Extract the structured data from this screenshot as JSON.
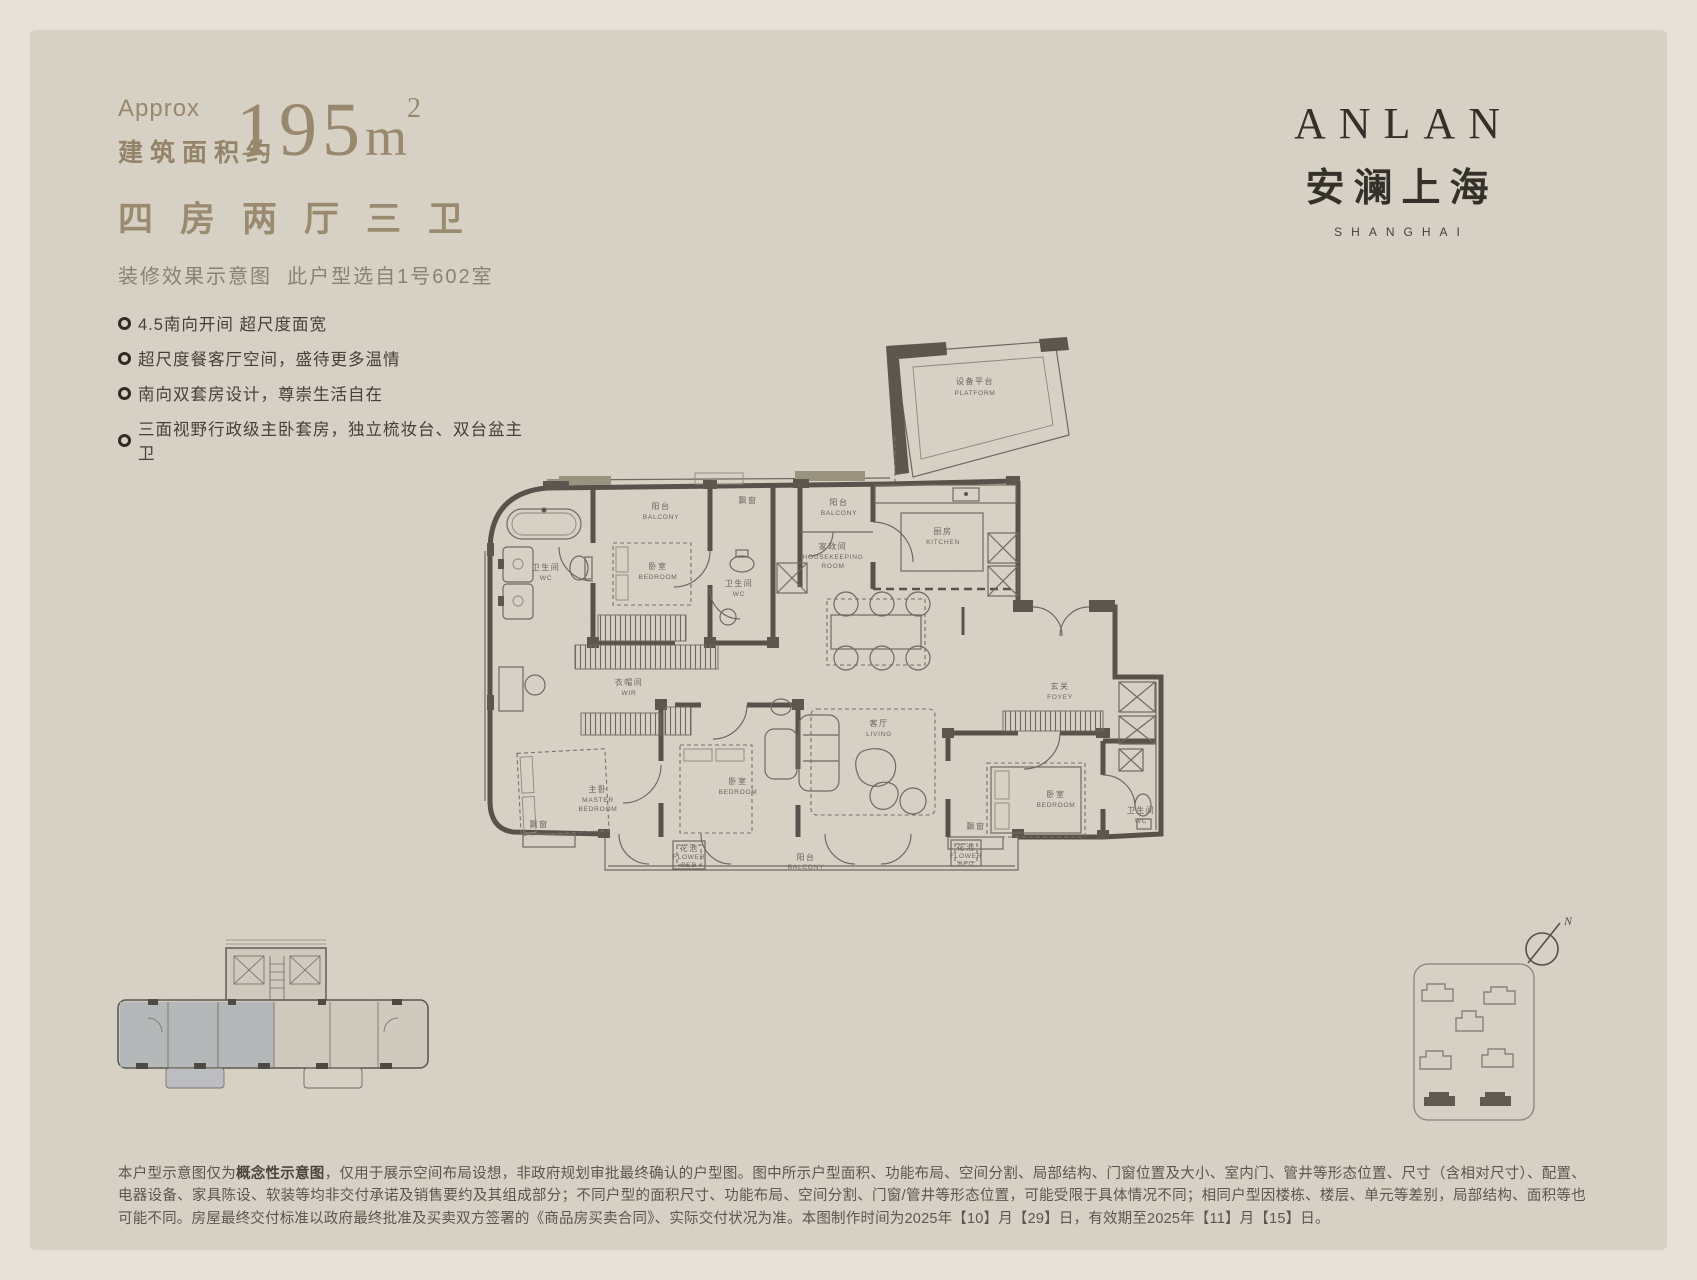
{
  "colors": {
    "paper": "#d7d0c4",
    "frame": "#e7e1d7",
    "gold": "#98896e",
    "ink": "#45413a",
    "plan_ink": "#57524b"
  },
  "header": {
    "approx": "Approx",
    "area_prefix": "建筑面积约",
    "area_value": "195",
    "area_unit": "m",
    "area_exp": "2",
    "rooms_chars": [
      "四",
      "房",
      "两",
      "厅",
      "三",
      "卫"
    ],
    "note_line": "装修效果示意图  此户型选自1号602室"
  },
  "features": [
    "4.5南向开间 超尺度面宽",
    "超尺度餐客厅空间，盛待更多温情",
    "南向双套房设计，尊崇生活自在",
    "三面视野行政级主卧套房，独立梳妆台、双台盆主卫"
  ],
  "brand": {
    "en": "ANLAN",
    "cn": "安澜上海",
    "city": "SHANGHAI"
  },
  "floorplan": {
    "rooms": [
      {
        "cn": "设备平台",
        "en": "PLATFORM"
      },
      {
        "cn": "阳台",
        "en": "BALCONY"
      },
      {
        "cn": "飘窗",
        "en": ""
      },
      {
        "cn": "卧室",
        "en": "BEDROOM"
      },
      {
        "cn": "卫生间",
        "en": "WC"
      },
      {
        "cn": "卫生间",
        "en": "WC"
      },
      {
        "cn": "阳台",
        "en": "BALCONY"
      },
      {
        "cn": "家政间",
        "en": "HOUSEKEEPING",
        "en2": "ROOM"
      },
      {
        "cn": "厨房",
        "en": "KITCHEN"
      },
      {
        "cn": "玄关",
        "en": "FOYEY"
      },
      {
        "cn": "客厅",
        "en": "LIVING"
      },
      {
        "cn": "衣帽间",
        "en": "WIR"
      },
      {
        "cn": "主卧",
        "en": "MASTER",
        "en2": "BEDROOM"
      },
      {
        "cn": "卧室",
        "en": "BEDROOM"
      },
      {
        "cn": "卧室",
        "en": "BEDROOM"
      },
      {
        "cn": "卫生间",
        "en": "WC"
      },
      {
        "cn": "花池",
        "en": "FLOWER",
        "en2": "BED"
      },
      {
        "cn": "阳台",
        "en": "BALCONY"
      },
      {
        "cn": "花池",
        "en": "FLOWER",
        "en2": "BED"
      },
      {
        "cn": "飘窗",
        "en": ""
      },
      {
        "cn": "飘窗",
        "en": ""
      }
    ]
  },
  "compass": {
    "north": "N"
  },
  "disclaimer": {
    "p1": "本户型示意图仅为",
    "bold": "概念性示意图",
    "p2": "，仅用于展示空间布局设想，非政府规划审批最终确认的户型图。图中所示户型面积、功能布局、空间分割、局部结构、门窗位置及大小、室内门、管井等形态位置、尺寸（含相对尺寸）、配置、电器设备、家具陈设、软装等均非交付承诺及销售要约及其组成部分；不同户型的面积尺寸、功能布局、空间分割、门窗/管井等形态位置，可能受限于具体情况不同；相同户型因楼栋、楼层、单元等差别，局部结构、面积等也可能不同。房屋最终交付标准以政府最终批准及买卖双方签署的《商品房买卖合同》、实际交付状况为准。本图制作时间为2025年【10】月【29】日，有效期至2025年【11】月【15】日。"
  }
}
